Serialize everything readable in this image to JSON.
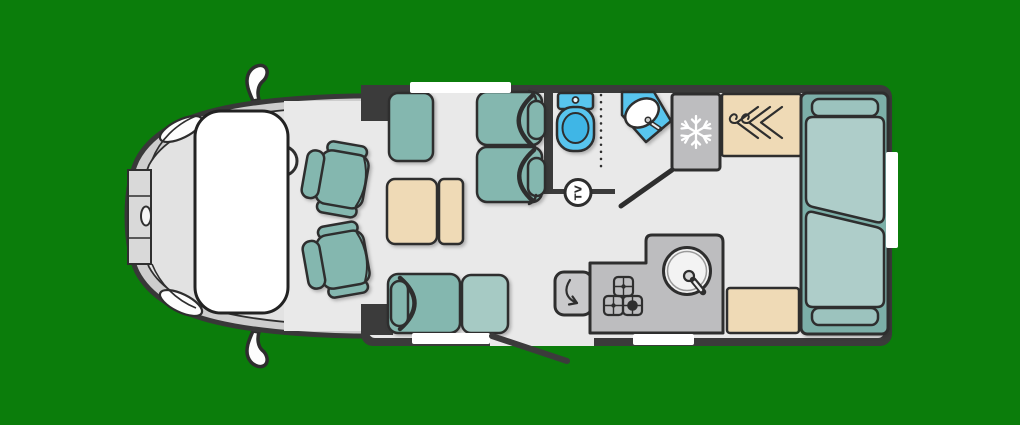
{
  "scene": {
    "description": "motorhome-floorplan-top-view-cutaway",
    "background_color": "#0b7d0b"
  },
  "colors": {
    "background": "#0b7d0b",
    "wall": "#3b3b3b",
    "outline": "#2e2e2e",
    "floor": "#e9e9e9",
    "cab_body": "#cdcdcd",
    "cab_bonnet": "#e2e2e2",
    "upholstery": "#84b7af",
    "upholstery_light": "#a6cac4",
    "bed_base": "#7cafa8",
    "bed_mattress": "#aecdc9",
    "bed_pillow": "#9cc3be",
    "wood": "#efdab6",
    "appliance": "#bdbdbf",
    "appliance_light": "#c9c9cb",
    "fixture_blue": "#58c5ee",
    "fixture_blue_dark": "#3fb6e6",
    "window": "#ffffff"
  },
  "labels": {
    "tv_badge": "TV"
  },
  "icons": {
    "fridge": "snowflake-icon",
    "wardrobe": "coat-hangers-icon",
    "hob": "three-burner-hob-icon",
    "sink": "round-bowl-tap-icon",
    "worktop": "swing-arrow-icon",
    "tv": "tv-circle-badge"
  },
  "zones": {
    "cab": [
      "windscreen",
      "steering-wheel",
      "driver-swivel-seat",
      "passenger-swivel-seat",
      "wing-mirror-top",
      "wing-mirror-bottom",
      "headlight-top",
      "headlight-bottom",
      "front-bumper",
      "door-handle"
    ],
    "lounge": [
      "side-sofa",
      "table-with-extension-leaf",
      "travel-seat-1",
      "travel-seat-2",
      "bench-seat",
      "ottoman-seat",
      "entry-door-open"
    ],
    "washroom": [
      "toilet",
      "shower-screen",
      "corner-washbasin",
      "washroom-door-open",
      "tv-mount"
    ],
    "kitchen": [
      "flip-up-worktop",
      "three-burner-hob",
      "round-sink",
      "fridge-freezer"
    ],
    "bedroom": [
      "wardrobe",
      "rear-bed",
      "upper-mattress",
      "lower-mattress",
      "top-pillow-shelf",
      "bottom-pillow-shelf",
      "bedside-unit"
    ],
    "windows": [
      "front-lounge-window",
      "bench-window",
      "kitchen-window",
      "bedroom-side-window"
    ]
  }
}
